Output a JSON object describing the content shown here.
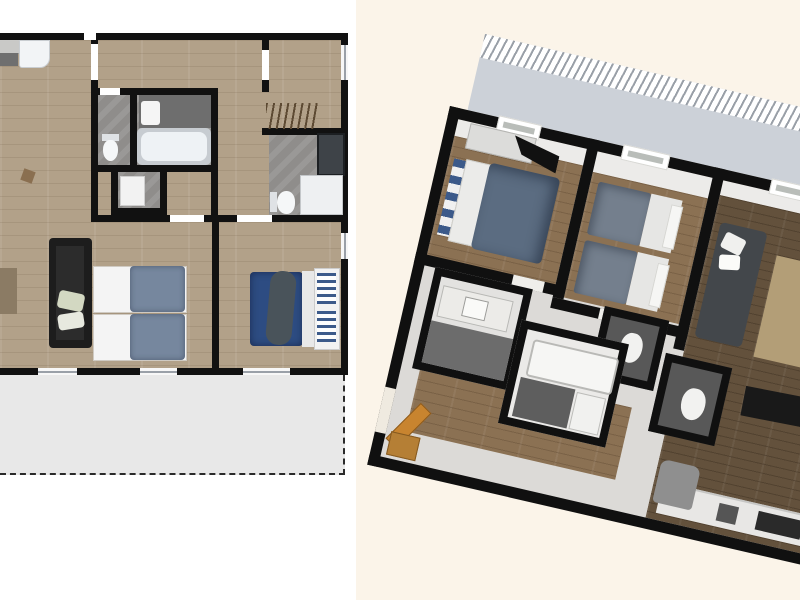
{
  "page": {
    "description": "Two floor-plan renderings of the same apartment shown side by side with no text labels",
    "background_left": "#ffffff",
    "background_right": "#fbf4e9"
  },
  "colors": {
    "wall": "#111111",
    "floor_wood_2d": "#b2a189",
    "floor_wood_3d_bedroom": "#8b7153",
    "floor_wood_3d_living": "#63513c",
    "bathroom_tile": "#8f8d8b",
    "dark_tile_3d": "#585858",
    "terrace_2d": "#e8e8e8",
    "terrace_3d": "#ccd1d8",
    "bed_duvet_blue_gray": "#76879e",
    "bed_duvet_navy": "#2d4c82",
    "sofa_black": "#1d1d1d",
    "sofa_gray_3d": "#43474b",
    "rug_beige": "#b39e77",
    "door_wood": "#c8842f",
    "fixture_white": "#f2f4f6"
  },
  "left_plan": {
    "label": "2D top-down floor plan",
    "view": "2d",
    "rooms": [
      {
        "name": "living-kitchen",
        "fixtures": [
          "kitchen-counter",
          "refrigerator",
          "sofa",
          "side-table",
          "chair"
        ]
      },
      {
        "name": "bathroom",
        "fixtures": [
          "vanity-counter",
          "sink",
          "bathtub",
          "toilet"
        ]
      },
      {
        "name": "shower-closet",
        "fixtures": [
          "shower-tray"
        ]
      },
      {
        "name": "wardrobe-room",
        "fixtures": [
          "clothes-rail"
        ]
      },
      {
        "name": "shower-room",
        "fixtures": [
          "glass-shower",
          "shower-tray",
          "toilet"
        ]
      },
      {
        "name": "twin-bedroom",
        "fixtures": [
          "single-bed",
          "single-bed"
        ]
      },
      {
        "name": "double-bedroom",
        "fixtures": [
          "double-bed",
          "striped-headboard"
        ]
      },
      {
        "name": "terrace",
        "style": "dashed-outline"
      }
    ]
  },
  "right_plan": {
    "label": "3D tilted floor plan",
    "view": "3d",
    "rotation_deg": 13,
    "rooms": [
      {
        "name": "double-bedroom",
        "fixtures": [
          "wardrobe",
          "wall-tv",
          "double-bed",
          "striped-headboard",
          "window"
        ]
      },
      {
        "name": "twin-bedroom",
        "fixtures": [
          "single-bed",
          "single-bed",
          "window"
        ]
      },
      {
        "name": "living-room",
        "fixtures": [
          "sofa",
          "beige-rug",
          "black-rug",
          "armchair",
          "armchair",
          "side-table",
          "window"
        ]
      },
      {
        "name": "kitchen",
        "fixtures": [
          "counter",
          "cooktop",
          "sink",
          "lounge-chair"
        ]
      },
      {
        "name": "vanity-bathroom",
        "fixtures": [
          "counter",
          "sink"
        ]
      },
      {
        "name": "bathtub-room",
        "fixtures": [
          "bathtub",
          "washer"
        ]
      },
      {
        "name": "wc-1",
        "fixtures": [
          "toilet"
        ]
      },
      {
        "name": "wc-2",
        "fixtures": [
          "toilet"
        ]
      },
      {
        "name": "entry-hall",
        "fixtures": [
          "open-wood-door",
          "cabinet"
        ]
      },
      {
        "name": "terrace",
        "style": "railing-hatch"
      }
    ]
  }
}
